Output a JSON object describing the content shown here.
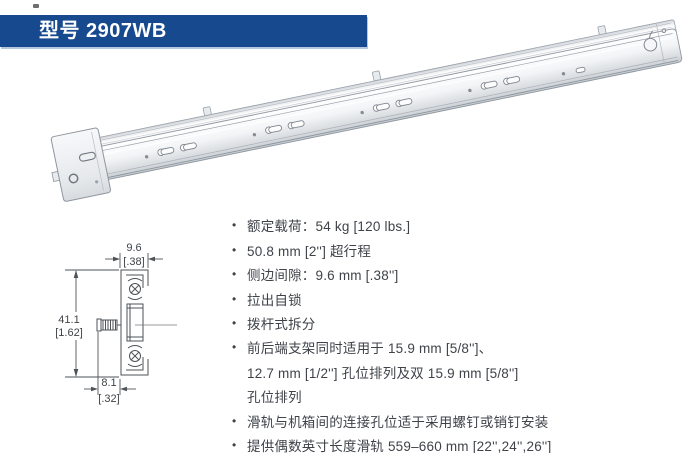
{
  "header": {
    "title": "型号 2907WB",
    "bg_color": "#17498f"
  },
  "product_image": {
    "description": "full-extension ball-bearing drawer slide, extended, shown diagonally"
  },
  "diagram": {
    "width_mm": "9.6",
    "width_in": "[.38]",
    "height_mm": "41.1",
    "height_in": "[1.62]",
    "offset_mm": "8.1",
    "offset_in": "[.32]"
  },
  "specs": [
    {
      "marker": "•",
      "text": "额定载荷：54 kg [120 lbs.]"
    },
    {
      "marker": "•",
      "text": "50.8 mm [2''] 超行程"
    },
    {
      "marker": "•",
      "text": "侧边间隙：9.6 mm [.38'']"
    },
    {
      "marker": "•",
      "text": "拉出自锁"
    },
    {
      "marker": "•",
      "text": "拨杆式拆分"
    },
    {
      "marker": "•",
      "text": "前后端支架同时适用于 15.9 mm [5/8'']、"
    },
    {
      "marker": "",
      "text": "12.7 mm [1/2''] 孔位排列及双 15.9 mm [5/8'']"
    },
    {
      "marker": "",
      "text": "孔位排列"
    },
    {
      "marker": "•",
      "text": "滑轨与机箱间的连接孔位适于采用螺钉或销钉安装"
    },
    {
      "marker": "•",
      "text": "提供偶数英寸长度滑轨 559–660 mm [22'',24'',26'']"
    }
  ]
}
